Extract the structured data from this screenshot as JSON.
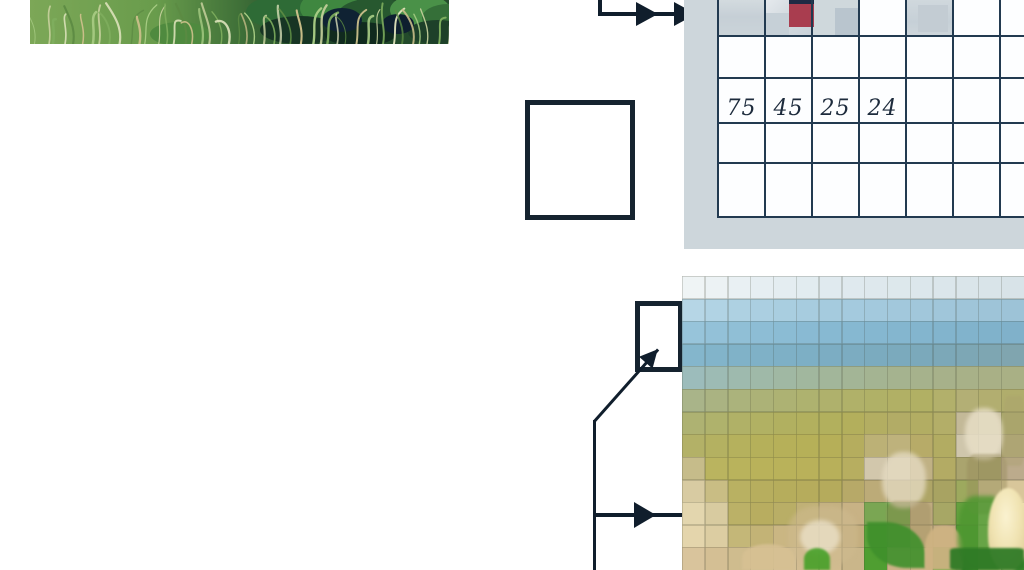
{
  "figure": {
    "description_visible_text_only": true,
    "colors": {
      "connector": "#101e2c",
      "outline": "#15232f",
      "panel": "#cdd6db",
      "gridline": "#223a50",
      "cellbg": "#fdfeff",
      "value_text": "#1d2b3c"
    }
  },
  "value_grid": {
    "values": [
      "75",
      "45",
      "25",
      "24"
    ],
    "shaded_cells": [
      {
        "x": 0,
        "w": 47,
        "bg": "linear-gradient(180deg,#d3dbdf 0%,#c6cfd6 45%,#cbd4d9 100%)"
      },
      {
        "x": 47,
        "w": 47,
        "bg": "linear-gradient(135deg,#e6eaee 0%,#d5dce1 40%,#c8d1d8 100%)"
      },
      {
        "x": 94,
        "w": 47,
        "bg": "#cfd8dc"
      },
      {
        "x": 188,
        "w": 47,
        "bg": "linear-gradient(180deg,#d0d8dd 0%,#c6d0d7 60%,#ced6db 100%)"
      }
    ],
    "patches": [
      {
        "x": 47,
        "y": 13,
        "w": 24,
        "h": 24,
        "color": "#c6d0d7"
      },
      {
        "x": 117,
        "y": 8,
        "w": 24,
        "h": 29,
        "color": "#b9c5ce"
      },
      {
        "x": 200,
        "y": 5,
        "w": 30,
        "h": 27,
        "color": "#c3ccd3"
      }
    ],
    "navy_bar": {
      "x": 71,
      "y": 0,
      "w": 25,
      "h": 5,
      "color": "#1e2a44"
    },
    "red_cell": {
      "x": 71,
      "y": 4,
      "w": 25,
      "h": 23,
      "color": "#a93d4f"
    }
  },
  "grass_photo": {
    "bg_stops": [
      "#7ca757",
      "#699c4c",
      "#3f7038",
      "#1f4429",
      "#254d2c"
    ],
    "blade_colors": [
      "#a9cd85",
      "#c4cf9b",
      "#7fae5e",
      "#e0e4bd",
      "#5c8a43",
      "#cbbf8a"
    ],
    "leaf_blobs": [
      [
        250,
        12,
        34,
        16,
        "#2e6b36"
      ],
      [
        300,
        8,
        30,
        18,
        "#3f8740"
      ],
      [
        345,
        16,
        38,
        18,
        "#27582f"
      ],
      [
        390,
        10,
        30,
        16,
        "#4a9148"
      ],
      [
        418,
        18,
        26,
        14,
        "#356f38"
      ],
      [
        270,
        30,
        40,
        14,
        "#173524"
      ],
      [
        330,
        34,
        36,
        12,
        "#102a1e"
      ],
      [
        408,
        32,
        30,
        12,
        "#1d4029"
      ],
      [
        312,
        20,
        20,
        12,
        "#0f2233"
      ],
      [
        368,
        24,
        16,
        10,
        "#0e1f2f"
      ],
      [
        150,
        34,
        30,
        12,
        "#4f8a3f"
      ]
    ]
  },
  "pixel_image": {
    "cols": 15,
    "rows_count": 13,
    "rows": [
      [
        "#eff4f5",
        "#ecf2f4",
        "#e9f0f3",
        "#e6eef2",
        "#e4edf1",
        "#e2ecf0",
        "#e0eaef",
        "#dfe9ee",
        "#dee8ed",
        "#dde8ec",
        "#dce7ec",
        "#dbe6eb",
        "#dae5ea",
        "#d9e4e9",
        "#d8e3e8"
      ],
      [
        "#b6d6e6",
        "#b1d3e4",
        "#aed1e2",
        "#abcfe1",
        "#a9cee0",
        "#a7ccdf",
        "#a5cbde",
        "#a4cade",
        "#a3c9dd",
        "#a2c8dc",
        "#a1c7db",
        "#a0c6da",
        "#9fc5d9",
        "#9ec4d8",
        "#9dc3d7"
      ],
      [
        "#97c4da",
        "#93c1d8",
        "#90bfd6",
        "#8dbdd5",
        "#8bbcd4",
        "#89bad3",
        "#87b9d2",
        "#86b8d1",
        "#85b7d0",
        "#84b6cf",
        "#83b5ce",
        "#82b4cd",
        "#81b3cc",
        "#80b2cb",
        "#80b1ca"
      ],
      [
        "#84b6cc",
        "#82b4ca",
        "#80b2c8",
        "#7fb1c7",
        "#7eb0c6",
        "#7dafc5",
        "#7cadc3",
        "#7cacc1",
        "#7babbf",
        "#7baabd",
        "#7ba9bb",
        "#7ca8b8",
        "#7da7b5",
        "#7ea6b2",
        "#80a5af"
      ],
      [
        "#9cbcbb",
        "#9dbbb4",
        "#9ebaae",
        "#9fb9a8",
        "#a0b8a3",
        "#a1b79e",
        "#a2b69a",
        "#a3b596",
        "#a4b492",
        "#a5b38f",
        "#a6b28c",
        "#a7b18a",
        "#a8b188",
        "#a9b086",
        "#a9b085"
      ],
      [
        "#a9b489",
        "#aab382",
        "#abb37c",
        "#acb277",
        "#adb273",
        "#aeb26f",
        "#afb16c",
        "#b0b169",
        "#b0b167",
        "#b1b065",
        "#b1b064",
        "#b2b06b",
        "#b3af75",
        "#b2ae70",
        "#b0ad6c"
      ],
      [
        "#aeb272",
        "#afb26c",
        "#b0b167",
        "#b1b163",
        "#b1b060",
        "#b2b05e",
        "#b2b05d",
        "#b3af5c",
        "#b3ae62",
        "#b2ac66",
        "#b2ad63",
        "#b3ae68",
        "#c3b998",
        "#c9c0a0",
        "#aba86c"
      ],
      [
        "#b3b167",
        "#b4b161",
        "#b5b15d",
        "#b5b05a",
        "#b6b059",
        "#b6b058",
        "#b6af58",
        "#b5ad5e",
        "#bcb176",
        "#beb27c",
        "#b7ab68",
        "#b2ac62",
        "#cfc6ac",
        "#d2c9b0",
        "#b1a878"
      ],
      [
        "#c6bc8a",
        "#bab45f",
        "#b9b35c",
        "#b9b25a",
        "#b9b25a",
        "#b9b15a",
        "#b8b05a",
        "#b7ae60",
        "#d2c7ac",
        "#d5cab0",
        "#c0b184",
        "#b3ab64",
        "#aaa46e",
        "#a5a06a",
        "#bcab8c"
      ],
      [
        "#d8cba2",
        "#c9bd84",
        "#b9b162",
        "#b7ae5e",
        "#b6ad5c",
        "#b6ac5c",
        "#b5ab5c",
        "#b7a968",
        "#bcab78",
        "#b4a670",
        "#aea566",
        "#a8a362",
        "#9da95e",
        "#cdc290",
        "#d8c69a"
      ],
      [
        "#e3d6ae",
        "#d8cba0",
        "#bbb167",
        "#b8ad60",
        "#b9ae66",
        "#c0b176",
        "#c4b180",
        "#c8b285",
        "#7aa653",
        "#62a03f",
        "#c0ac80",
        "#a7a765",
        "#66a13f",
        "#f2e7bd",
        "#f0e2b2"
      ],
      [
        "#e4d5ac",
        "#dccda2",
        "#c4b778",
        "#c3b376",
        "#cab683",
        "#ceb988",
        "#ccb584",
        "#c4ae7e",
        "#5ba23a",
        "#6ba148",
        "#c9b184",
        "#c3ad82",
        "#559a35",
        "#f6edc4",
        "#efe0ae"
      ],
      [
        "#d9c49c",
        "#d4bf94",
        "#cfbc8e",
        "#d2bd92",
        "#d5c095",
        "#d3bd92",
        "#d2bc90",
        "#cab68a",
        "#4f9e31",
        "#cdb287",
        "#d0b588",
        "#46a42a",
        "#2f7d26",
        "#cfc490",
        "#3f8c30"
      ]
    ],
    "details": [
      {
        "name": "wheat-head-cluster-b",
        "x": 283,
        "y": 132,
        "w": 38,
        "h": 52,
        "bg": "rgba(233,224,200,0.8)",
        "radius": "45%",
        "blur": 2
      },
      {
        "name": "wheat-head-cluster-a",
        "x": 200,
        "y": 176,
        "w": 44,
        "h": 56,
        "bg": "rgba(228,218,192,0.8)",
        "radius": "45%",
        "blur": 2
      },
      {
        "name": "wheat-stalks-b",
        "x": 285,
        "y": 178,
        "w": 40,
        "h": 60,
        "bg": "rgba(150,140,92,0.45)",
        "radius": "20%",
        "blur": 1
      },
      {
        "name": "wheat-stalks-a",
        "x": 205,
        "y": 225,
        "w": 44,
        "h": 48,
        "bg": "rgba(158,142,96,0.45)",
        "radius": "20%",
        "blur": 1
      },
      {
        "name": "wheat-sketch-right",
        "x": 322,
        "y": 120,
        "w": 20,
        "h": 70,
        "bg": "rgba(170,160,110,0.4)",
        "radius": "20%",
        "blur": 1
      },
      {
        "name": "wheat-cluster-c",
        "x": 106,
        "y": 230,
        "w": 70,
        "h": 60,
        "bg": "rgba(205,185,142,0.55)",
        "radius": "40%",
        "blur": 2
      },
      {
        "name": "wheat-speckles-c",
        "x": 118,
        "y": 244,
        "w": 40,
        "h": 34,
        "bg": "rgba(238,230,208,0.7)",
        "radius": "50%",
        "blur": 2
      },
      {
        "name": "green-leaf-left",
        "x": 185,
        "y": 246,
        "w": 58,
        "h": 46,
        "bg": "rgba(62,143,43,0.9)",
        "radius": "0 70% 0 70%",
        "blur": 1
      },
      {
        "name": "tan-trunk",
        "x": 243,
        "y": 250,
        "w": 38,
        "h": 44,
        "bg": "rgba(205,178,130,0.95)",
        "radius": "45% 45% 10% 10%",
        "blur": 1
      },
      {
        "name": "small-tan-cone",
        "x": 60,
        "y": 268,
        "w": 52,
        "h": 26,
        "bg": "rgba(214,192,146,0.9)",
        "radius": "50% 50% 0 0",
        "blur": 1
      },
      {
        "name": "green-patch-right",
        "x": 276,
        "y": 220,
        "w": 42,
        "h": 74,
        "bg": "rgba(78,150,48,0.85)",
        "radius": "40% 20% 0 40%",
        "blur": 2
      },
      {
        "name": "pale-bulb",
        "x": 306,
        "y": 212,
        "w": 40,
        "h": 82,
        "bg": "radial-gradient(ellipse at 45% 35%, #faf2d0 0%, #f0e3b2 45%, #d8c48e 100%)",
        "radius": "50% 50% 42% 42%",
        "blur": 1
      },
      {
        "name": "dark-green-bottom-right",
        "x": 268,
        "y": 272,
        "w": 74,
        "h": 22,
        "bg": "rgba(47,122,38,0.95)",
        "radius": "10%",
        "blur": 1
      },
      {
        "name": "green-tuft-bottom-mid",
        "x": 122,
        "y": 272,
        "w": 26,
        "h": 22,
        "bg": "rgba(70,160,40,0.9)",
        "radius": "50% 50% 0 0",
        "blur": 1
      }
    ]
  }
}
